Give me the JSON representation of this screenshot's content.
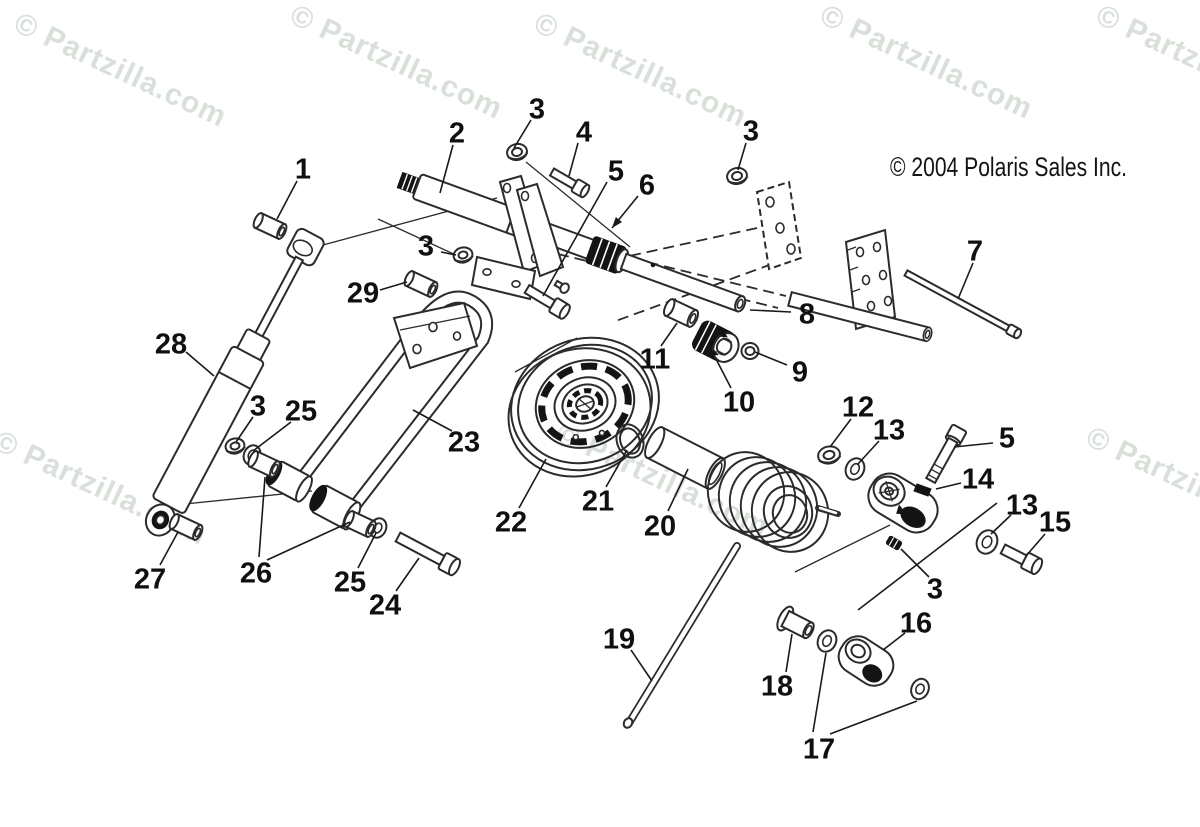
{
  "page": {
    "background": "#ffffff"
  },
  "copyright": {
    "text": "© 2004 Polaris Sales Inc."
  },
  "watermark": {
    "text": "© Partzilla.com",
    "color": "#d9e0d9",
    "highlight": "#ffffff",
    "angle": 25,
    "positions": [
      [
        12,
        30
      ],
      [
        288,
        22
      ],
      [
        532,
        30
      ],
      [
        818,
        22
      ],
      [
        1094,
        22
      ],
      [
        -8,
        448
      ],
      [
        554,
        440
      ],
      [
        1084,
        444
      ]
    ]
  },
  "leader_color": "#1a1a1a",
  "callouts": [
    {
      "label": "1",
      "x": 303,
      "y": 168,
      "leaders": [
        [
          297,
          181,
          277,
          219
        ]
      ]
    },
    {
      "label": "2",
      "x": 457,
      "y": 132,
      "leaders": [
        [
          453,
          145,
          440,
          193
        ]
      ]
    },
    {
      "label": "3",
      "x": 537,
      "y": 108,
      "leaders": [
        [
          531,
          120,
          514,
          148
        ]
      ]
    },
    {
      "label": "4",
      "x": 584,
      "y": 131,
      "leaders": [
        [
          578,
          143,
          569,
          176
        ]
      ]
    },
    {
      "label": "5",
      "x": 616,
      "y": 170,
      "leaders": [
        [
          607,
          182,
          543,
          296
        ]
      ]
    },
    {
      "label": "6",
      "x": 647,
      "y": 184,
      "leaders": [
        [
          638,
          196,
          612,
          228
        ]
      ],
      "arrow": true
    },
    {
      "label": "3",
      "x": 751,
      "y": 130,
      "leaders": [
        [
          746,
          143,
          738,
          170
        ]
      ]
    },
    {
      "label": "3",
      "x": 426,
      "y": 245,
      "leaders": [
        [
          441,
          252,
          456,
          255
        ]
      ]
    },
    {
      "label": "29",
      "x": 363,
      "y": 292,
      "leaders": [
        [
          380,
          290,
          407,
          282
        ]
      ]
    },
    {
      "label": "28",
      "x": 171,
      "y": 343,
      "leaders": [
        [
          186,
          352,
          214,
          376
        ]
      ]
    },
    {
      "label": "8",
      "x": 807,
      "y": 313,
      "leaders": [
        [
          791,
          312,
          750,
          310
        ]
      ]
    },
    {
      "label": "7",
      "x": 975,
      "y": 250,
      "leaders": [
        [
          973,
          263,
          958,
          299
        ]
      ]
    },
    {
      "label": "9",
      "x": 800,
      "y": 371,
      "leaders": [
        [
          787,
          365,
          755,
          352
        ]
      ]
    },
    {
      "label": "10",
      "x": 739,
      "y": 401,
      "leaders": [
        [
          731,
          388,
          716,
          359
        ]
      ]
    },
    {
      "label": "11",
      "x": 655,
      "y": 358,
      "leaders": [
        [
          661,
          346,
          677,
          323
        ]
      ]
    },
    {
      "label": "23",
      "x": 464,
      "y": 441,
      "leaders": [
        [
          452,
          431,
          413,
          410
        ]
      ]
    },
    {
      "label": "3",
      "x": 258,
      "y": 405,
      "leaders": [
        [
          253,
          417,
          236,
          442
        ]
      ]
    },
    {
      "label": "25",
      "x": 301,
      "y": 410,
      "leaders": [
        [
          291,
          422,
          253,
          451
        ]
      ]
    },
    {
      "label": "22",
      "x": 511,
      "y": 521,
      "leaders": [
        [
          519,
          508,
          546,
          459
        ]
      ]
    },
    {
      "label": "21",
      "x": 598,
      "y": 500,
      "leaders": [
        [
          606,
          487,
          627,
          450
        ]
      ]
    },
    {
      "label": "20",
      "x": 660,
      "y": 525,
      "leaders": [
        [
          668,
          511,
          688,
          469
        ]
      ]
    },
    {
      "label": "12",
      "x": 858,
      "y": 406,
      "leaders": [
        [
          851,
          419,
          830,
          447
        ]
      ]
    },
    {
      "label": "13",
      "x": 889,
      "y": 429,
      "leaders": [
        [
          879,
          441,
          858,
          464
        ]
      ]
    },
    {
      "label": "5",
      "x": 1007,
      "y": 437,
      "leaders": [
        [
          993,
          443,
          954,
          447
        ]
      ]
    },
    {
      "label": "14",
      "x": 978,
      "y": 478,
      "leaders": [
        [
          961,
          483,
          936,
          489
        ]
      ]
    },
    {
      "label": "13",
      "x": 1022,
      "y": 504,
      "leaders": [
        [
          1011,
          515,
          991,
          534
        ],
        [
          997,
          503,
          858,
          610
        ]
      ]
    },
    {
      "label": "15",
      "x": 1055,
      "y": 521,
      "leaders": [
        [
          1045,
          534,
          1026,
          556
        ]
      ]
    },
    {
      "label": "27",
      "x": 150,
      "y": 578,
      "leaders": [
        [
          160,
          565,
          178,
          532
        ]
      ]
    },
    {
      "label": "26",
      "x": 256,
      "y": 572,
      "leaders": [
        [
          259,
          557,
          265,
          477
        ],
        [
          267,
          560,
          350,
          522
        ]
      ]
    },
    {
      "label": "25",
      "x": 350,
      "y": 581,
      "leaders": [
        [
          358,
          568,
          376,
          533
        ]
      ]
    },
    {
      "label": "24",
      "x": 385,
      "y": 604,
      "leaders": [
        [
          396,
          591,
          419,
          558
        ]
      ]
    },
    {
      "label": "3",
      "x": 935,
      "y": 588,
      "leaders": [
        [
          929,
          577,
          901,
          549
        ]
      ]
    },
    {
      "label": "19",
      "x": 619,
      "y": 638,
      "leaders": [
        [
          631,
          650,
          652,
          681
        ]
      ]
    },
    {
      "label": "18",
      "x": 777,
      "y": 685,
      "leaders": [
        [
          786,
          672,
          792,
          634
        ]
      ]
    },
    {
      "label": "16",
      "x": 916,
      "y": 622,
      "leaders": [
        [
          905,
          633,
          883,
          650
        ]
      ]
    },
    {
      "label": "17",
      "x": 819,
      "y": 748,
      "leaders": [
        [
          813,
          732,
          826,
          653
        ],
        [
          830,
          734,
          917,
          701
        ]
      ]
    }
  ]
}
